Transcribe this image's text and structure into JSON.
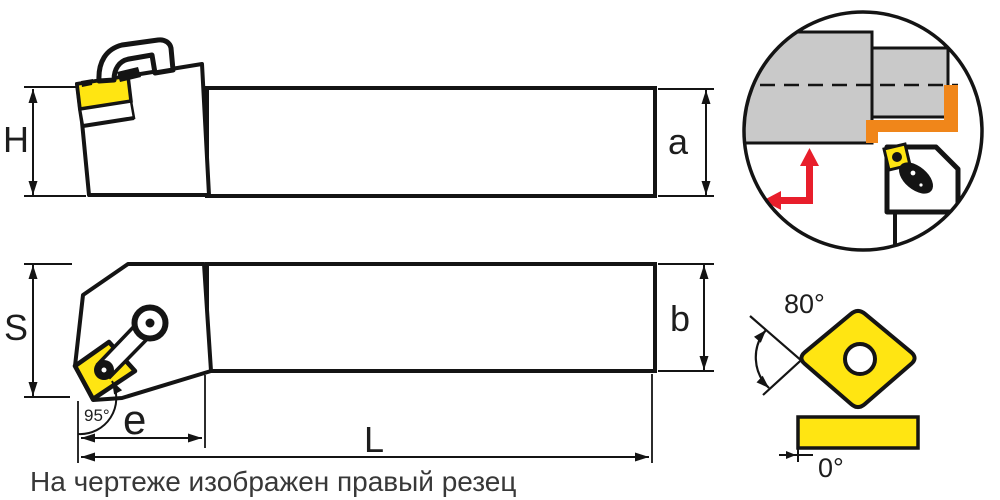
{
  "caption": "На чертеже изображен правый резец",
  "dimension_labels": {
    "holder_height": "H",
    "cut_height": "a",
    "holder_width": "S",
    "shank_width": "b",
    "head_length": "e",
    "overall_length": "L"
  },
  "angle_labels": {
    "entering_angle": "95°",
    "insert_point_angle": "80°",
    "insert_clearance_angle": "0°"
  },
  "figures": {
    "side_view": "tool-holder-side-view",
    "top_view": "tool-holder-top-view",
    "application_inset": "turning-operation-inset",
    "insert_detail": "insert-shape-detail"
  },
  "colors": {
    "insert_yellow": "#ffe512",
    "toolpath_orange": "#f0861a",
    "workpiece_gray": "#c9c9c9",
    "feed_arrow_red": "#e81e2b",
    "outline_black": "#141414"
  }
}
